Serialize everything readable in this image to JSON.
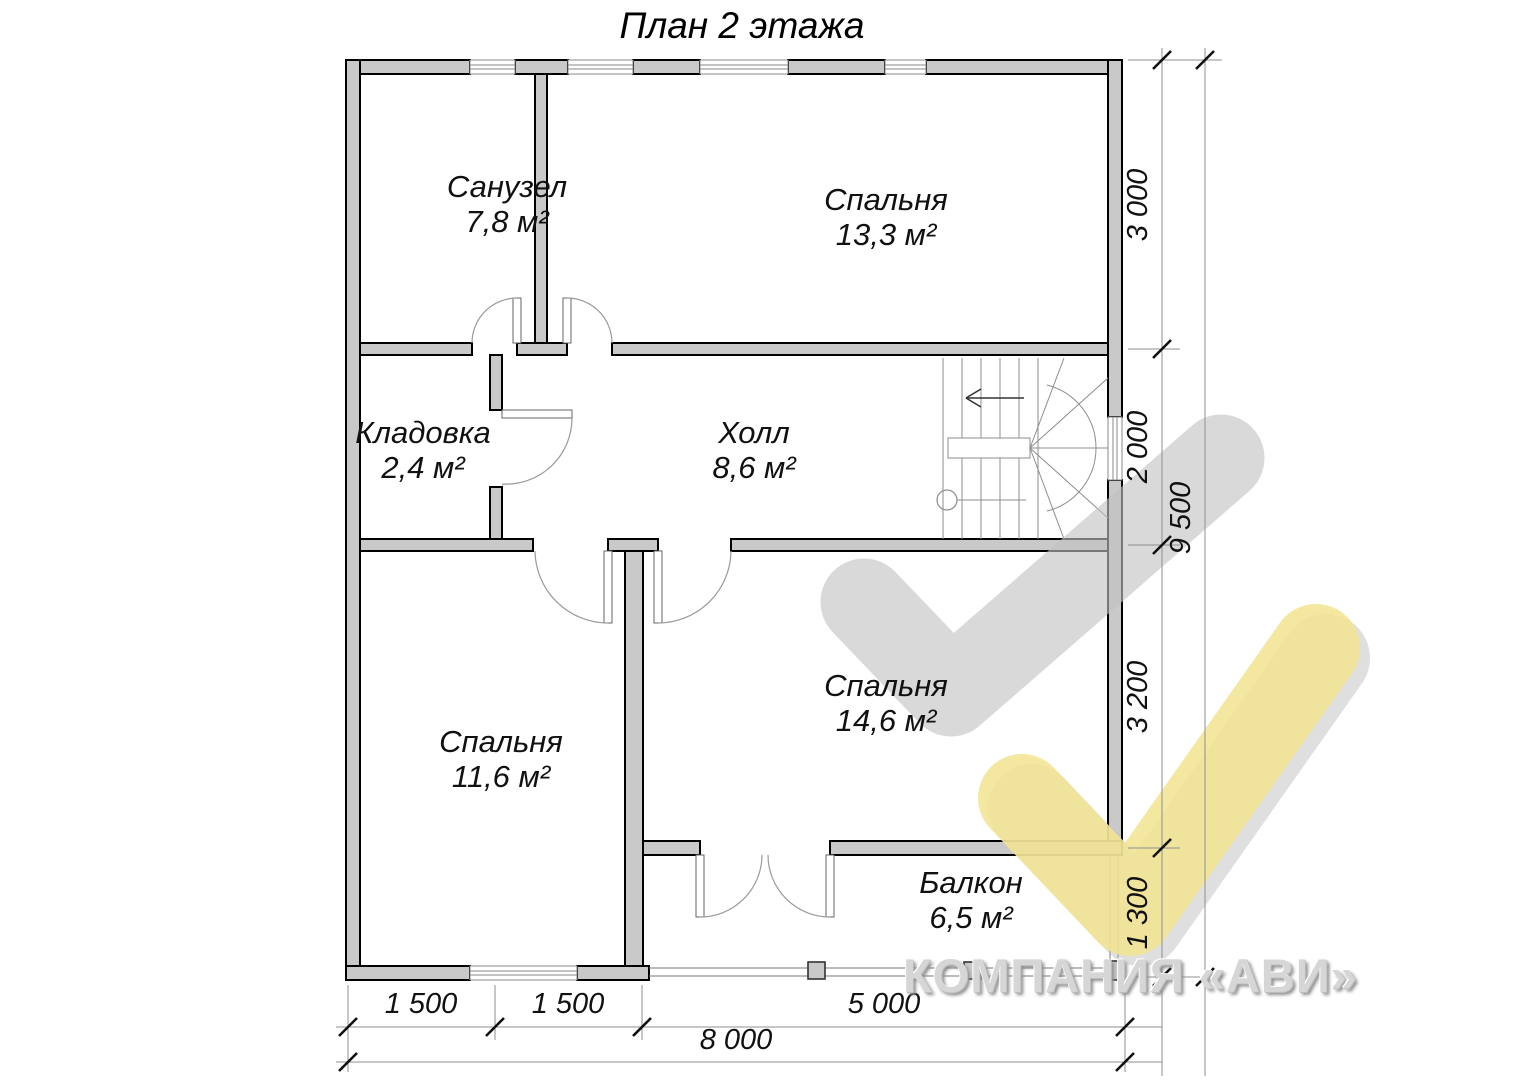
{
  "title": "План 2 этажа",
  "rooms": {
    "sanuzel": {
      "name": "Санузел",
      "area": "7,8 м²"
    },
    "bedroom_top": {
      "name": "Спальня",
      "area": "13,3 м²"
    },
    "kladovka": {
      "name": "Кладовка",
      "area": "2,4 м²"
    },
    "hall": {
      "name": "Холл",
      "area": "8,6 м²"
    },
    "bedroom_left": {
      "name": "Спальня",
      "area": "11,6 м²"
    },
    "bedroom_right": {
      "name": "Спальня",
      "area": "14,6 м²"
    },
    "balcony": {
      "name": "Балкон",
      "area": "6,5 м²"
    }
  },
  "dimensions": {
    "right_3000": "3 000",
    "right_2000": "2 000",
    "right_3200": "3 200",
    "right_1300": "1 300",
    "right_total": "9 500",
    "bottom_1500a": "1 500",
    "bottom_1500b": "1 500",
    "bottom_5000": "5 000",
    "bottom_total": "8 000"
  },
  "watermark": {
    "company": "КОМПАНИЯ «АВИ»"
  },
  "colors": {
    "wall_fill": "#c9c9c9",
    "check_gray": "#c2c2c2",
    "check_yellow": "#f2e493"
  }
}
